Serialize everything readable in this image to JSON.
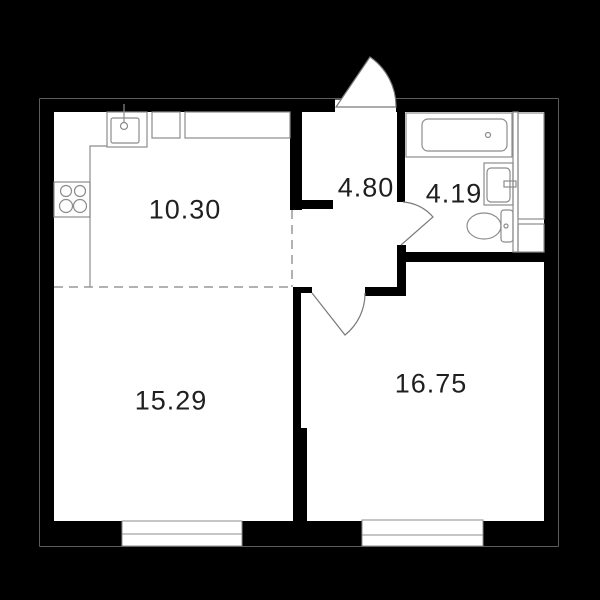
{
  "floor_plan": {
    "title": "apartment-floor-plan",
    "units": "square-meters",
    "rooms": [
      {
        "name": "kitchen",
        "area_label": "10.30"
      },
      {
        "name": "hallway",
        "area_label": "4.80"
      },
      {
        "name": "bathroom",
        "area_label": "4.19"
      },
      {
        "name": "living-room",
        "area_label": "15.29"
      },
      {
        "name": "room",
        "area_label": "16.75"
      }
    ],
    "fixtures": [
      "kitchen-sink",
      "stove-burners",
      "kitchen-cabinets",
      "counter",
      "bathtub",
      "wash-basin",
      "toilet",
      "duct-shaft",
      "entrance-door",
      "bathroom-door",
      "room-door",
      "window-left",
      "window-right"
    ],
    "colors": {
      "background": "#000000",
      "wall": "#000000",
      "floor": "#ffffff",
      "fixture_line": "#8c8c8c",
      "door_line": "#7a7a7a",
      "dashed_zone_line": "#999999",
      "label_text": "#1f1f1f"
    }
  }
}
